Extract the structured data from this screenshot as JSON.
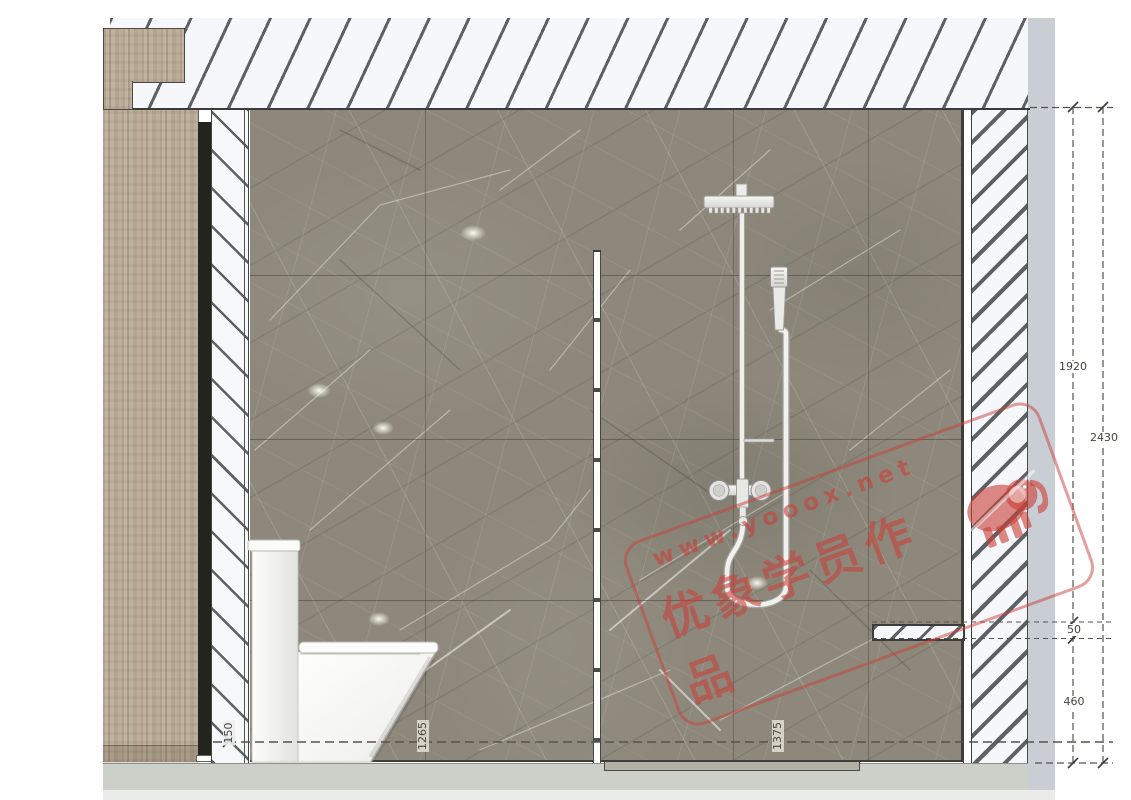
{
  "watermark": {
    "url": "www.yooox.net",
    "caption": "优象学员作品"
  },
  "dimensions": {
    "d1920": "1920",
    "d2430": "2430",
    "d50": "50",
    "d460": "460",
    "d150": "150",
    "d1265": "1265",
    "d1375": "1375"
  },
  "icons": {
    "elephant": "elephant-logo-icon"
  },
  "colors": {
    "stamp-red": "#c94039",
    "marble-base": "#8d887b",
    "wood-base": "#b7a894",
    "floor-band": "#cdd0c9",
    "side-band": "#c9cdd4",
    "hatch-line": "#5d6166",
    "line-dark": "#3c3c38",
    "dim-line": "#54544e",
    "dim-text": "#45453f"
  }
}
